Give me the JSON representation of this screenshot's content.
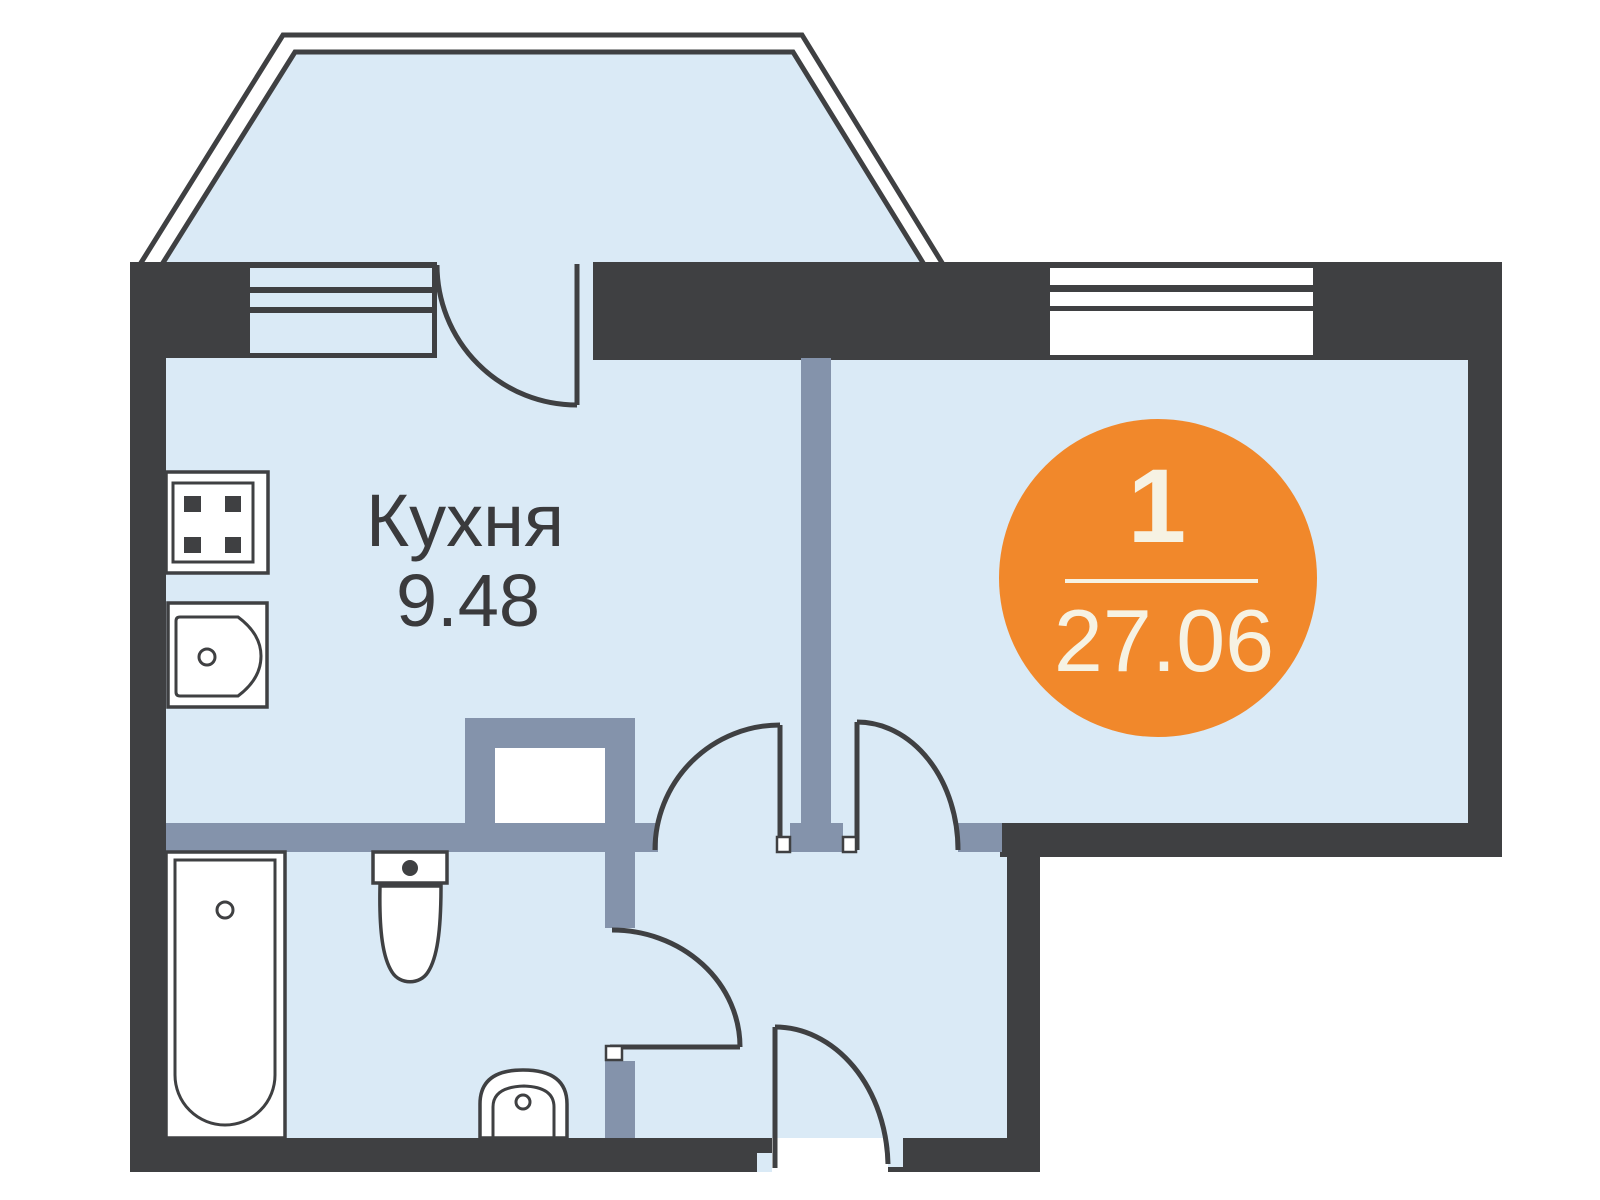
{
  "floor_plan": {
    "rooms": [
      {
        "name": "Кухня",
        "area": "9.48"
      }
    ],
    "badge": {
      "room_count": "1",
      "total_area": "27.06"
    }
  },
  "colors": {
    "wall_dark": "#3F4042",
    "partition_gray_blue": "#8493AB",
    "floor_fill_blue": "#DAEAF6",
    "accent_orange": "#F1882B",
    "badge_text_cream": "#F6F2E3",
    "label_text": "#3A3A3C",
    "fixture_fill": "#FFFFFF"
  }
}
